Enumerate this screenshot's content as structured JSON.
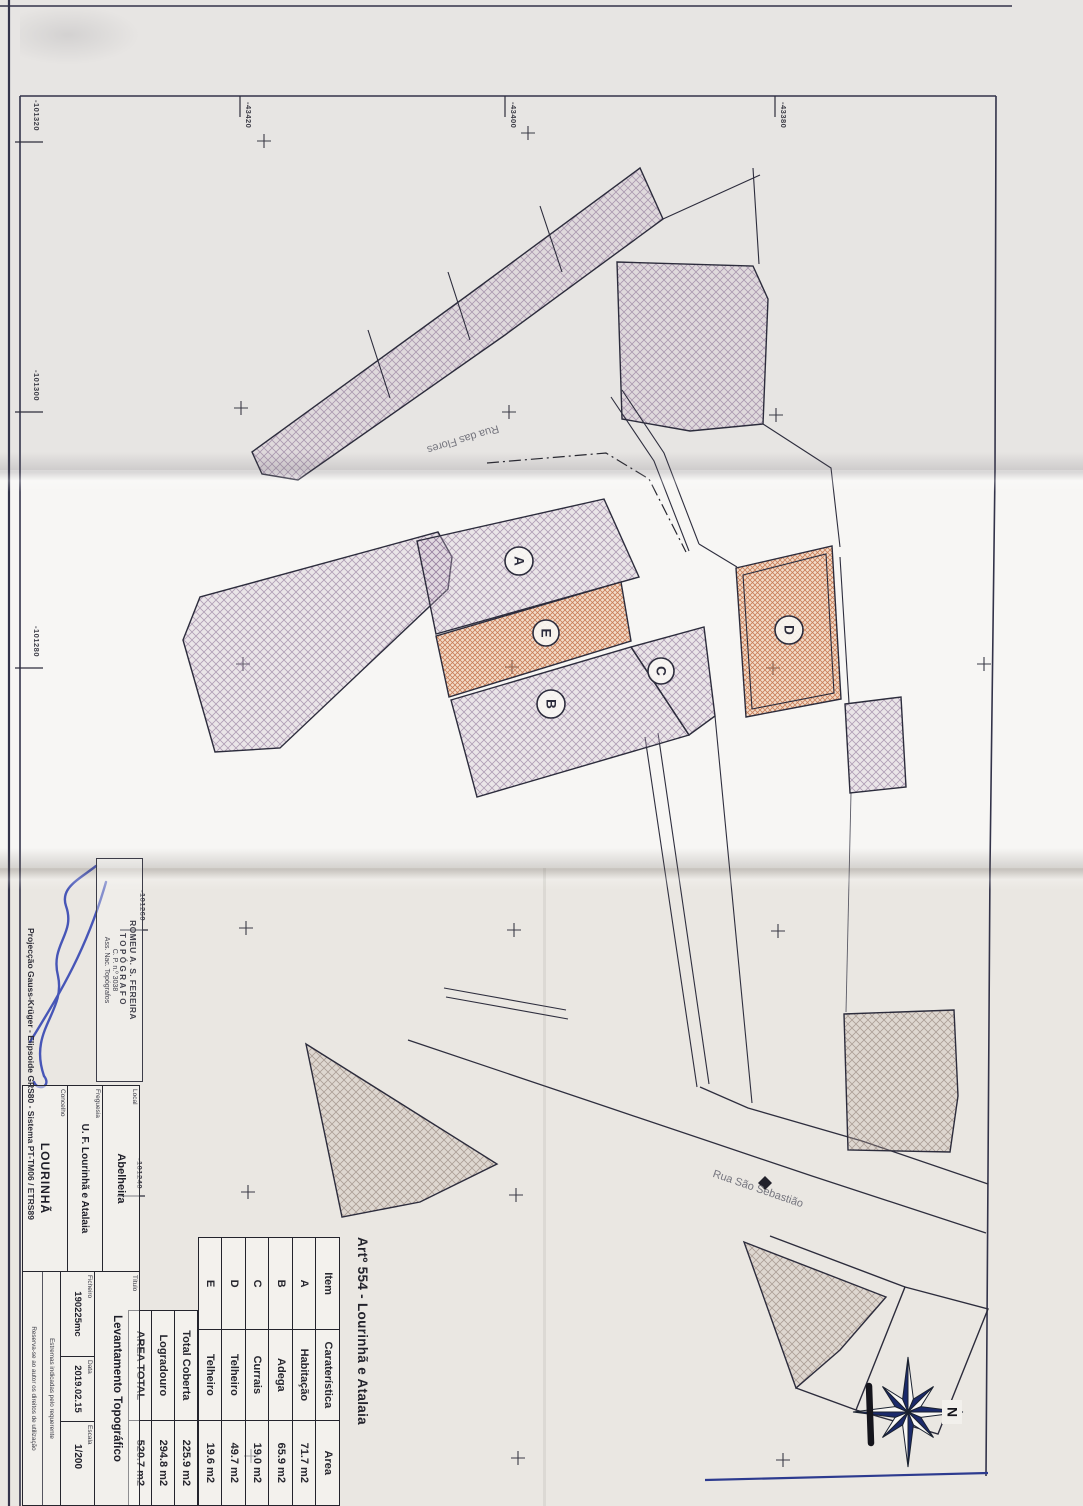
{
  "sheet": {
    "title": "Artº 554 - Lourinhã e Atalaia",
    "projection_note": "Projecção Gauss-Krüger - Elipsoide GRS80 - Sistema PT-TM06 / ETRS89"
  },
  "map": {
    "streets": [
      "Rua das Flores",
      "Rua São Sebastião"
    ],
    "parcel_labels": [
      "A",
      "B",
      "C",
      "D",
      "E"
    ],
    "grid_left": [
      "-101320",
      "-101300",
      "-101280",
      "-101260",
      "-101240"
    ],
    "grid_top": [
      "-43420",
      "-43400",
      "-43380"
    ],
    "north_label": "N"
  },
  "table": {
    "header": {
      "item": "Item",
      "caracteristica": "Caraterística",
      "area": "Area"
    },
    "rows": [
      {
        "item": "A",
        "caracteristica": "Habitação",
        "area": "71.7 m2"
      },
      {
        "item": "B",
        "caracteristica": "Adega",
        "area": "65.9 m2"
      },
      {
        "item": "C",
        "caracteristica": "Currais",
        "area": "19.0 m2"
      },
      {
        "item": "D",
        "caracteristica": "Telheiro",
        "area": "49.7 m2"
      },
      {
        "item": "E",
        "caracteristica": "Telheiro",
        "area": "19.6 m2"
      }
    ],
    "footer": [
      {
        "label": "Total Coberta",
        "value": "225.9 m2"
      },
      {
        "label": "Logradouro",
        "value": "294.8 m2"
      },
      {
        "label": "AREA TOTAL",
        "value": "520.7 m2"
      }
    ]
  },
  "title_block": {
    "local_label": "Local",
    "local_value": "Abelheira",
    "freguesia_label": "Freguesia",
    "freguesia_value": "U. F. Lourinhã e Atalaia",
    "concelho_label": "Concelho",
    "concelho_value": "LOURINHÃ",
    "titulo_label": "Título",
    "titulo_value": "Levantamento Topográfico",
    "ficheiro_label": "Ficheiro",
    "ficheiro_value": "190225mc",
    "data_label": "Data",
    "data_value": "2019.02.15",
    "escala_label": "Escala",
    "escala_value": "1/200",
    "note_line1": "Estremas indicadas pelo requerente",
    "note_line2": "Reserva-se ao autor os direitos de utilização"
  },
  "stamp": {
    "line1": "ROMEU A. S. FEREIRA",
    "line2": "TOPÓGRAFO",
    "line3": "C. P. n.º 3038",
    "line4": "Ass. Nac. Topógrafos"
  },
  "colors": {
    "ink": "#2c2c3c",
    "hatch_orange": "#c06b3e",
    "hatch_gray": "#8f7f95",
    "signature_blue": "#2b3db0",
    "compass_navy": "#1b2a6b"
  }
}
